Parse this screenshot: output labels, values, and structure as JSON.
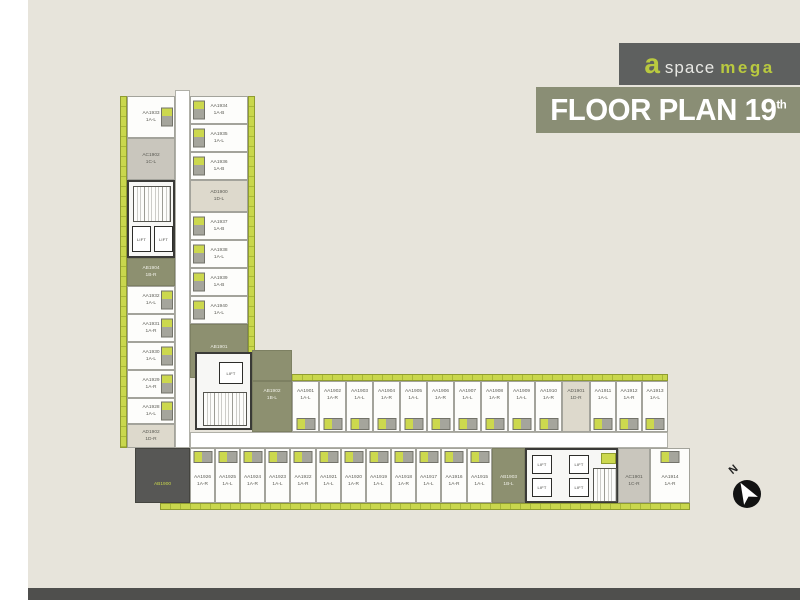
{
  "brand": {
    "a": "a",
    "space": "space",
    "mega": "mega"
  },
  "title": {
    "text": "FLOOR PLAN 19",
    "sup": "th"
  },
  "compass": {
    "label": "N"
  },
  "colors": {
    "accent_lime": "#c3d24a",
    "banner_olive": "#8a8e75",
    "badge_gray": "#5e605f",
    "unit_olive": "#8d9070",
    "unit_beige": "#ddd9cc",
    "unit_gray": "#c9c6bd",
    "unit_dark": "#575755",
    "footer_gray": "#4f4f4d",
    "background": "#e7e4db"
  },
  "plan": {
    "lift_label": "LIFT",
    "left_wing_left_col": [
      {
        "id": "AA1933",
        "type": "1A-L"
      },
      {
        "id": "AC1902",
        "type": "1C-L",
        "variant": "c"
      },
      {
        "id": "AB1904",
        "type": "1B-R",
        "variant": "b"
      },
      {
        "id": "AA1932",
        "type": "1A-L"
      },
      {
        "id": "AA1931",
        "type": "1A-R"
      },
      {
        "id": "AA1930",
        "type": "1A-L"
      },
      {
        "id": "AA1929",
        "type": "1A-R"
      },
      {
        "id": "AA1928",
        "type": "1A-L"
      },
      {
        "id": "AD1902",
        "type": "1D-R",
        "variant": "d"
      }
    ],
    "left_wing_right_col": [
      {
        "id": "AA1934",
        "type": "1A-B"
      },
      {
        "id": "AA1935",
        "type": "1A-L"
      },
      {
        "id": "AA1936",
        "type": "1A-B"
      },
      {
        "id": "AD1900",
        "type": "1D-L",
        "variant": "d"
      },
      {
        "id": "AA1937",
        "type": "1A-B"
      },
      {
        "id": "AA1938",
        "type": "1A-L"
      },
      {
        "id": "AA1939",
        "type": "1A-B"
      },
      {
        "id": "AA1940",
        "type": "1A-L"
      },
      {
        "id": "AB1901",
        "type": "1B-R",
        "variant": "b"
      }
    ],
    "bottom_wing_top_row": [
      {
        "id": "AB1902",
        "type": "1B-L",
        "variant": "b"
      },
      {
        "id": "AA1901",
        "type": "1A-L"
      },
      {
        "id": "AA1902",
        "type": "1A-R"
      },
      {
        "id": "AA1903",
        "type": "1A-L"
      },
      {
        "id": "AA1904",
        "type": "1A-R"
      },
      {
        "id": "AA1905",
        "type": "1A-L"
      },
      {
        "id": "AA1906",
        "type": "1A-R"
      },
      {
        "id": "AA1907",
        "type": "1A-L"
      },
      {
        "id": "AA1908",
        "type": "1A-R"
      },
      {
        "id": "AA1909",
        "type": "1A-L"
      },
      {
        "id": "AA1910",
        "type": "1A-R"
      },
      {
        "id": "AD1901",
        "type": "1D-R",
        "variant": "d"
      },
      {
        "id": "AA1911",
        "type": "1A-L"
      },
      {
        "id": "AA1912",
        "type": "1A-R"
      },
      {
        "id": "AA1913",
        "type": "1A-L"
      }
    ],
    "bottom_wing_bottom_row_left": [
      {
        "id": "AB1900",
        "variant": "dark"
      },
      {
        "id": "AA1926",
        "type": "1A-R"
      },
      {
        "id": "AA1925",
        "type": "1A-L"
      },
      {
        "id": "AA1924",
        "type": "1A-R"
      },
      {
        "id": "AA1923",
        "type": "1A-L"
      },
      {
        "id": "AA1922",
        "type": "1A-R"
      },
      {
        "id": "AA1921",
        "type": "1A-L"
      },
      {
        "id": "AA1920",
        "type": "1A-R"
      },
      {
        "id": "AA1919",
        "type": "1A-L"
      },
      {
        "id": "AA1918",
        "type": "1A-R"
      },
      {
        "id": "AA1917",
        "type": "1A-L"
      },
      {
        "id": "AA1916",
        "type": "1A-R"
      },
      {
        "id": "AA1915",
        "type": "1A-L"
      },
      {
        "id": "AB1903",
        "type": "1B-L",
        "variant": "b"
      }
    ],
    "bottom_wing_bottom_row_right": [
      {
        "id": "AC1901",
        "type": "1C-R",
        "variant": "c"
      },
      {
        "id": "AA1914",
        "type": "1A-R"
      }
    ]
  }
}
